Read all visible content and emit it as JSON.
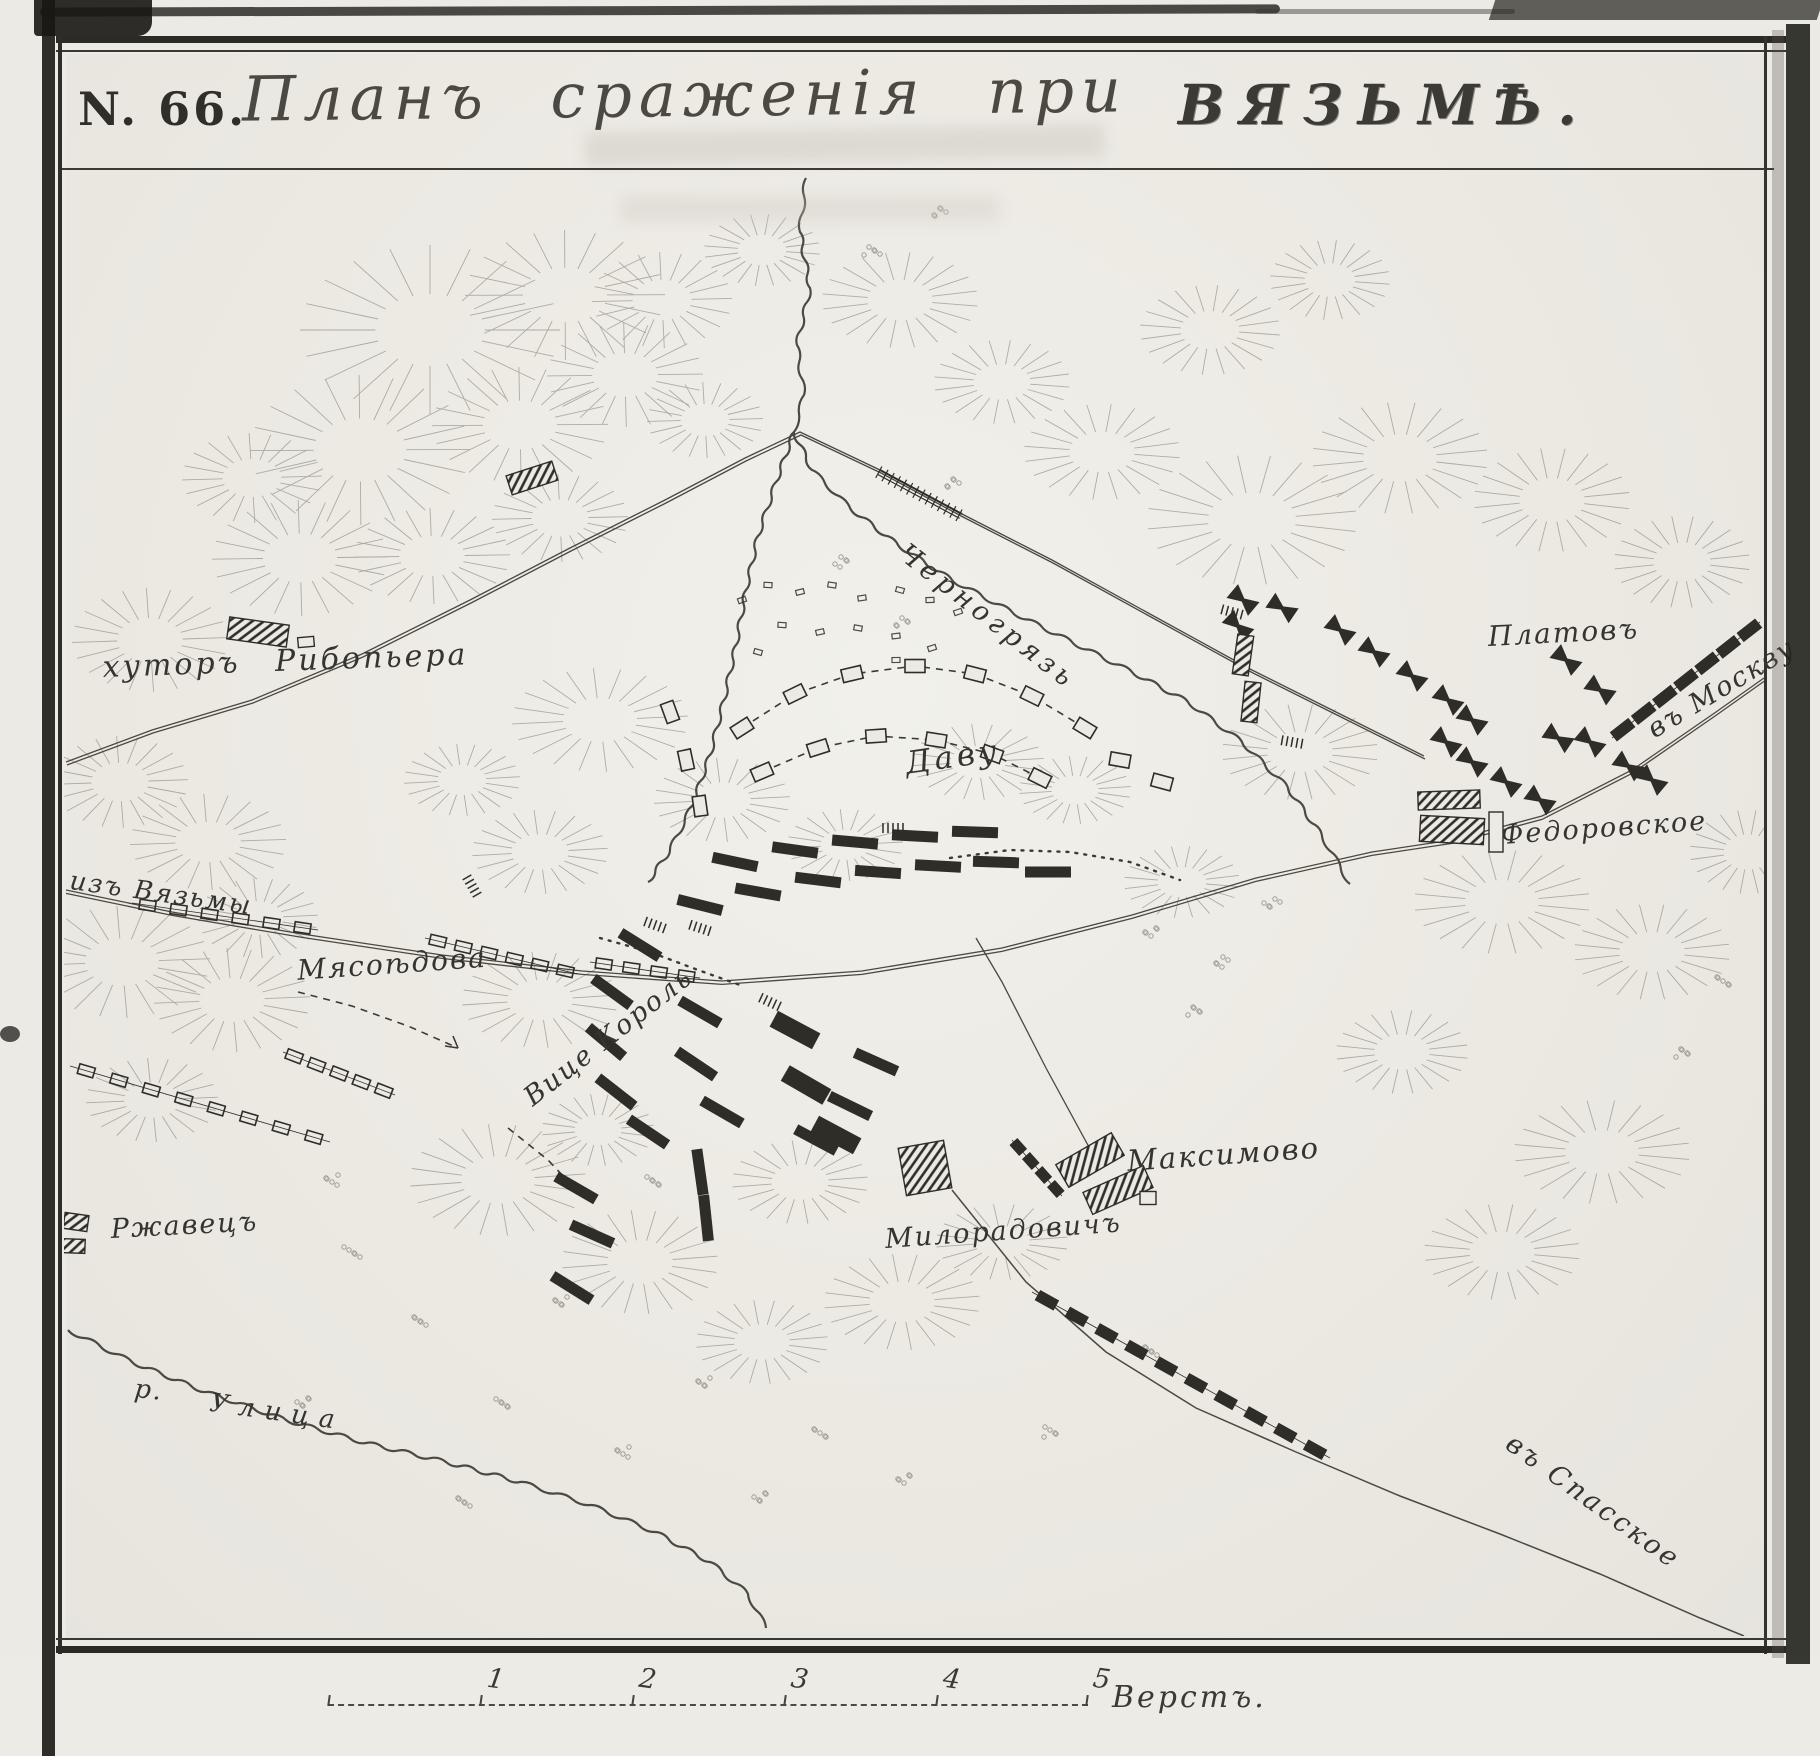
{
  "title": {
    "number": "N. 66.",
    "main": "Планъ сраженія при",
    "place": "ВЯЗЬМѢ."
  },
  "map": {
    "labels": [
      {
        "id": "khutor-ribopiera",
        "text": "хуторъ Рибопьера"
      },
      {
        "id": "chernogryaz-river",
        "text": "Черногрязь"
      },
      {
        "id": "platov",
        "text": "Платовъ"
      },
      {
        "id": "to-moscow",
        "text": "въ Москву"
      },
      {
        "id": "fedorovskoe",
        "text": "Федоровское"
      },
      {
        "id": "from-vyazma",
        "text": "изъ Вязьмы"
      },
      {
        "id": "myasoedova",
        "text": "Мясоѣдова"
      },
      {
        "id": "vice-korol",
        "text": "Вице Король"
      },
      {
        "id": "davout",
        "text": "Даву"
      },
      {
        "id": "maksimovo",
        "text": "Максимово"
      },
      {
        "id": "miloradovich",
        "text": "Милорадовичъ"
      },
      {
        "id": "rzhavets",
        "text": "Ржавецъ"
      },
      {
        "id": "river-abbr",
        "text": "р."
      },
      {
        "id": "ulitsa-river",
        "text": "Улица"
      },
      {
        "id": "to-spasskoe",
        "text": "въ Спасское"
      }
    ]
  },
  "scale": {
    "ticks": [
      "1",
      "2",
      "3",
      "4",
      "5"
    ],
    "unit": "Верстъ."
  },
  "colors": {
    "ink": "#2e2d28",
    "paper": "#eceae5",
    "hachure": "#7a786e"
  }
}
